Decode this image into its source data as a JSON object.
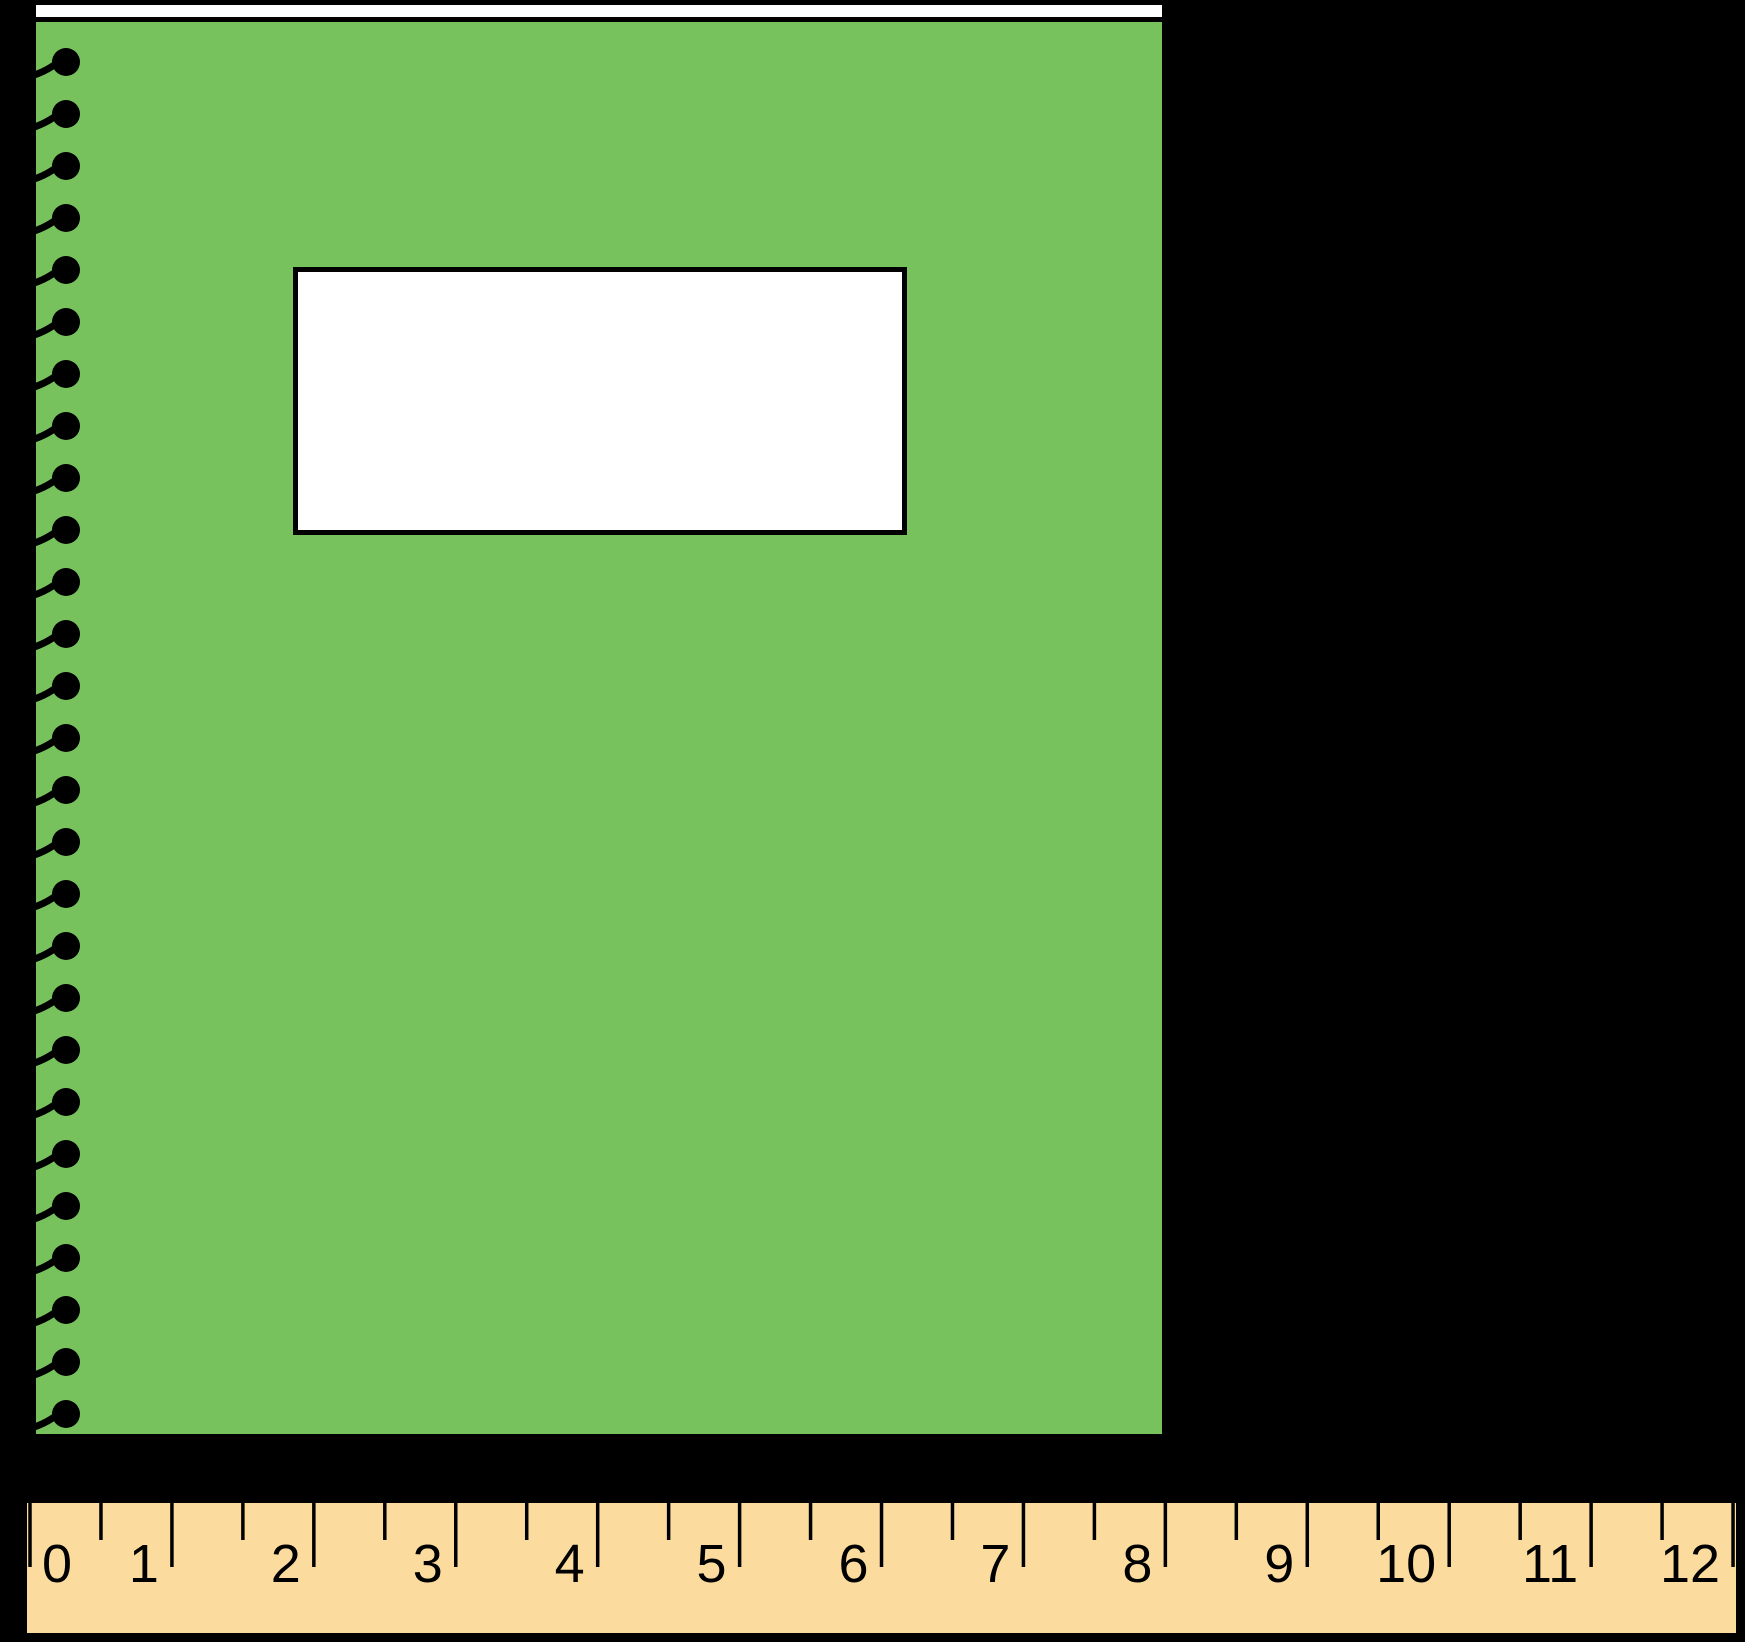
{
  "scene": {
    "description": "A green spiral-bound notebook with a blank white label, shown above an inch ruler; the notebook spans from the 0 mark to the 8 mark of the ruler",
    "background_color": "#000000"
  },
  "notebook": {
    "cover_color": "#77C25D",
    "binding_strip_color": "#FFFFFF",
    "label_fill_color": "#FFFFFF",
    "outline_color": "#000000",
    "spiral_color": "#000000",
    "spiral_ring_count": 27
  },
  "ruler": {
    "fill_color": "#FBDC9E",
    "border_color": "#000000",
    "tick_color": "#000000",
    "number_color": "#000000",
    "numbers": [
      "0",
      "1",
      "2",
      "3",
      "4",
      "5",
      "6",
      "7",
      "8",
      "9",
      "10",
      "11",
      "12"
    ],
    "unit_min": 0,
    "unit_max": 12,
    "has_half_inch_ticks": true
  }
}
